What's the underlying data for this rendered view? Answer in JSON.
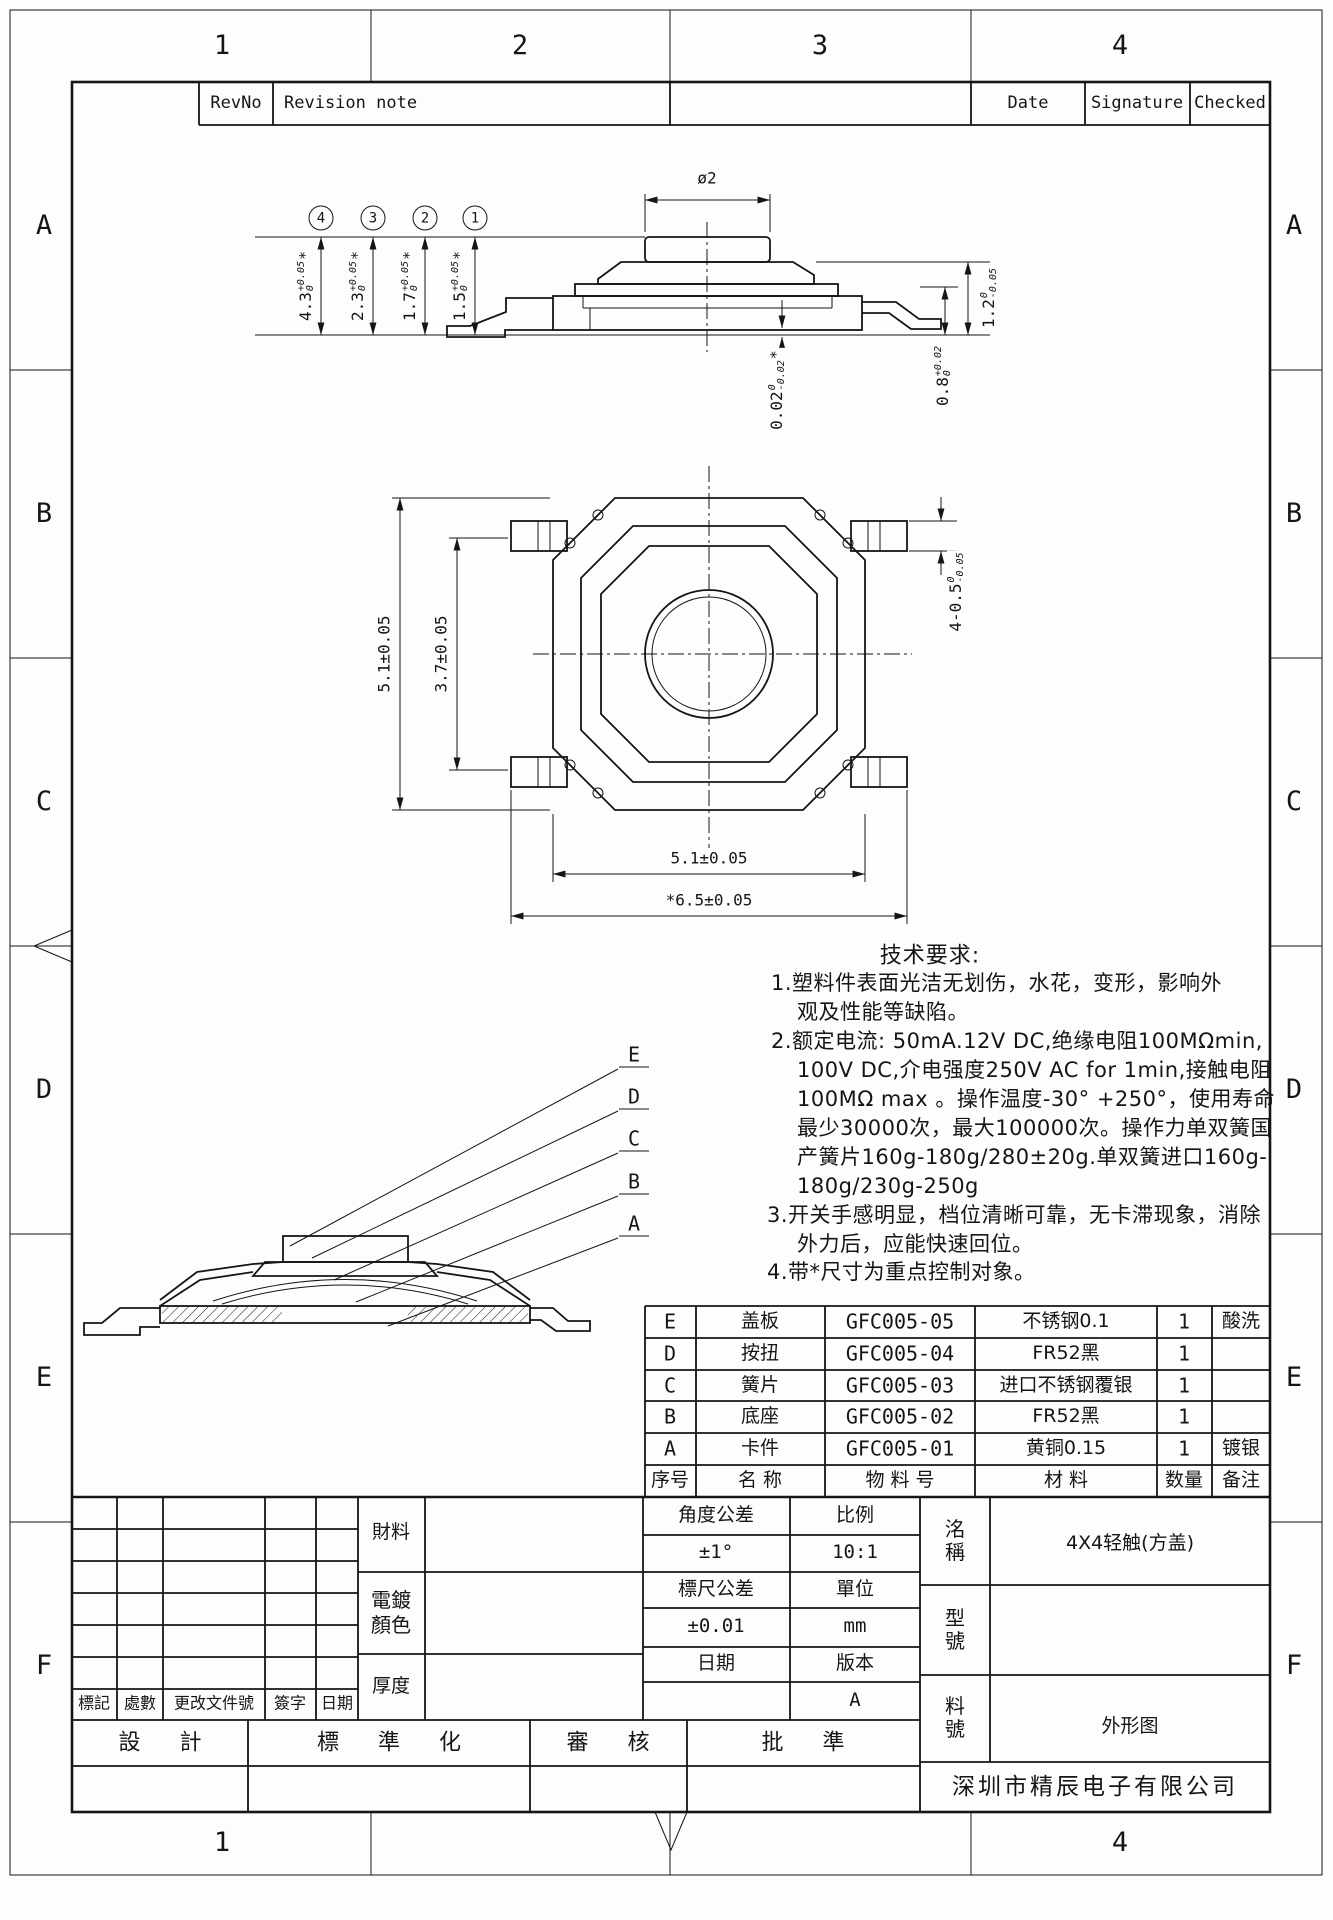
{
  "sheet": {
    "zones_top": [
      "1",
      "2",
      "3",
      "4"
    ],
    "zones_bottom": [
      "1",
      "4"
    ],
    "zones_left": [
      "A",
      "B",
      "C",
      "D",
      "E",
      "F"
    ],
    "zones_right": [
      "A",
      "B",
      "C",
      "D",
      "E",
      "F"
    ]
  },
  "revision_table": {
    "rev_no": "RevNo",
    "note": "Revision note",
    "date": "Date",
    "signature": "Signature",
    "checked": "Checked"
  },
  "side_view": {
    "top_dia": "ø2",
    "variant_dims": [
      {
        "ref": "4",
        "main": "4.3",
        "tol_top": "+0.05",
        "tol_bot": "0",
        "star": "*"
      },
      {
        "ref": "3",
        "main": "2.3",
        "tol_top": "+0.05",
        "tol_bot": "0",
        "star": "*"
      },
      {
        "ref": "2",
        "main": "1.7",
        "tol_top": "+0.05",
        "tol_bot": "0",
        "star": "*"
      },
      {
        "ref": "1",
        "main": "1.5",
        "tol_top": "+0.05",
        "tol_bot": "0",
        "star": "*"
      }
    ],
    "body_height": {
      "main": "1.2",
      "tol_top": "0",
      "tol_bot": "-0.05"
    },
    "terminal_height": {
      "main": "0.8",
      "tol_top": "+0.02",
      "tol_bot": "0"
    },
    "coplanarity": {
      "main": "0.02",
      "tol_top": "0",
      "tol_bot": "-0.02",
      "star": "*"
    }
  },
  "plan_view": {
    "dim_height": "5.1±0.05",
    "dim_lead_span": "3.7±0.05",
    "dim_tab": {
      "main": "4-0.5",
      "tol_top": "0",
      "tol_bot": "-0.05"
    },
    "dim_width": "5.1±0.05",
    "dim_outer_width": "*6.5±0.05"
  },
  "section_view": {
    "labels": [
      "E",
      "D",
      "C",
      "B",
      "A"
    ]
  },
  "tech_req": {
    "title": "技术要求:",
    "lines": [
      "1.塑料件表面光洁无划伤，水花，变形，影响外",
      "观及性能等缺陷。",
      "2.额定电流: 50mA.12V DC,绝缘电阻100MΩmin,",
      "100V DC,介电强度250V AC for 1min,接触电阻",
      "100MΩ max 。操作温度-30° +250°，使用寿命",
      "最少30000次，最大100000次。操作力单双簧国",
      "产簧片160g-180g/280±20g.单双簧进口160g-",
      "180g/230g-250g",
      "3.开关手感明显，档位清晰可靠，无卡滞现象，消除",
      "外力后，应能快速回位。",
      "4.带*尺寸为重点控制对象。"
    ]
  },
  "bom": {
    "headers": [
      "序号",
      "名 称",
      "物 料 号",
      "材 料",
      "数量",
      "备注"
    ],
    "rows": [
      [
        "E",
        "盖板",
        "GFC005-05",
        "不锈钢0.1",
        "1",
        "酸洗"
      ],
      [
        "D",
        "按扭",
        "GFC005-04",
        "FR52黑",
        "1",
        ""
      ],
      [
        "C",
        "簧片",
        "GFC005-03",
        "进口不锈钢覆银",
        "1",
        ""
      ],
      [
        "B",
        "底座",
        "GFC005-02",
        "FR52黑",
        "1",
        ""
      ],
      [
        "A",
        "卡件",
        "GFC005-01",
        "黄铜0.15",
        "1",
        "镀银"
      ]
    ]
  },
  "title_block": {
    "material_label": "財料",
    "plating_label": "電鍍顏色",
    "thickness_label": "厚度",
    "angle_tol_label": "角度公差",
    "angle_tol": "±1°",
    "scale_label": "比例",
    "scale": "10:1",
    "dim_tol_label": "標尺公差",
    "dim_tol": "±0.01",
    "unit_label": "單位",
    "unit": "mm",
    "date_label": "日期",
    "version_label": "版本",
    "version": "A",
    "name_label": "洺稱",
    "name": "4X4轻触(方盖)",
    "model_label": "型號",
    "part_no_label": "料號",
    "drawing_type": "外形图",
    "company": "深圳市精辰电子有限公司",
    "mark_label": "標記",
    "count_label": "處數",
    "change_doc_label": "更改文件號",
    "sign_label": "簽字",
    "date2_label": "日期",
    "design_label": "設 計",
    "standardize_label": "標 準 化",
    "review_label": "審 核",
    "approve_label": "批 準"
  }
}
